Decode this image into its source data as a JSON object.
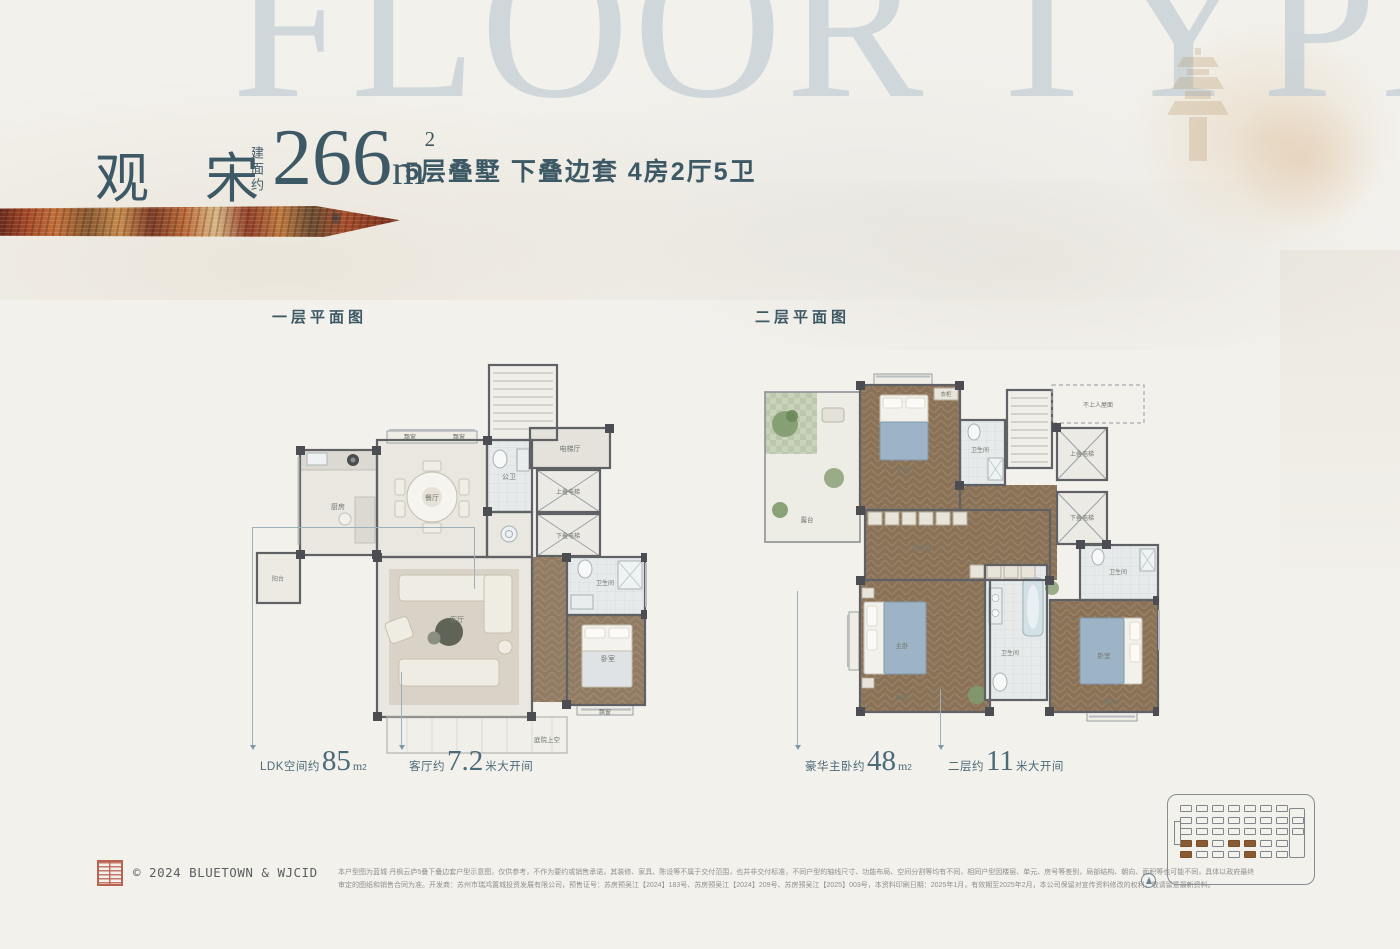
{
  "watermark": "FLOOR TYPE",
  "header": {
    "project_name": "观宋",
    "area_label_vertical": "建面约",
    "area_value": "266",
    "area_unit": "m",
    "area_sup": "2",
    "spec": "5层叠墅 下叠边套 4房2厅5卫"
  },
  "plan1": {
    "title": "一层平面图",
    "rooms": {
      "kitchen": "厨房",
      "dining": "餐厅",
      "powder": "公卫",
      "elevator_hall": "电梯厅",
      "elevator_up": "上叠电梯",
      "elevator_down": "下叠电梯",
      "living": "客厅",
      "bath": "卫生间",
      "bedroom": "卧室",
      "bay1": "飘窗",
      "bay2": "飘窗",
      "bay3": "飘窗",
      "balcony": "阳台",
      "courtyard": "庭院上空"
    }
  },
  "plan2": {
    "title": "二层平面图",
    "rooms": {
      "terrace": "露台",
      "bedroom_top": "卧室",
      "wardrobe": "衣柜",
      "bath_top": "卫生间",
      "roof": "不上人屋面",
      "elevator_up": "上叠电梯",
      "elevator_down": "下叠电梯",
      "cloakroom": "衣帽间",
      "master": "主卧",
      "master_bath": "卫生间",
      "bedroom_right": "卧室",
      "bath_right": "卫生间",
      "bay1": "飘窗",
      "bay2": "飘窗"
    }
  },
  "callouts": [
    {
      "prefix": "LDK空间约",
      "value": "85",
      "unit": "m",
      "sup": "2",
      "suffix": ""
    },
    {
      "prefix": "客厅约",
      "value": "7.2",
      "unit": "",
      "sup": "",
      "suffix": "米大开间"
    },
    {
      "prefix": "豪华主卧约",
      "value": "48",
      "unit": "m",
      "sup": "2",
      "suffix": ""
    },
    {
      "prefix": "二层约",
      "value": "11",
      "unit": "",
      "sup": "",
      "suffix": "米大开间"
    }
  ],
  "footer": {
    "copyright": "© 2024 BLUETOWN & WJCID",
    "disclaimer_line1": "本户型图为蓝城·丹枫云庐5叠下叠边套户型示意图，仅供参考，不作为要约或销售承诺，其装修、家具、陈设等不属于交付范围，也并非交付标准，不同户型的轴线尺寸、功能布局、空间分割等均有不同，相同户型因楼层、单元、房号等差别，局部结构、朝向、面积等也可能不同，具体以政府最终",
    "disclaimer_line2": "审定的图纸和销售合同为准。开发商：苏州市瑞鸿置城投资发展有限公司，预售证号：苏房预吴江【2024】183号、苏房预吴江【2024】209号、苏房预吴江【2025】003号，本资料印刷日期：2025年1月，有效期至2025年2月，本公司保留对宣传资料修改的权利，敬请留意最新资料。"
  },
  "minimap": {
    "rows": [
      {
        "shapes": 7,
        "brown": []
      },
      {
        "shapes": 8,
        "brown": []
      },
      {
        "shapes": 8,
        "brown": []
      },
      {
        "shapes": 7,
        "brown": [
          0,
          1,
          3,
          4
        ]
      },
      {
        "shapes": 7,
        "brown": [
          0,
          4
        ]
      }
    ]
  }
}
